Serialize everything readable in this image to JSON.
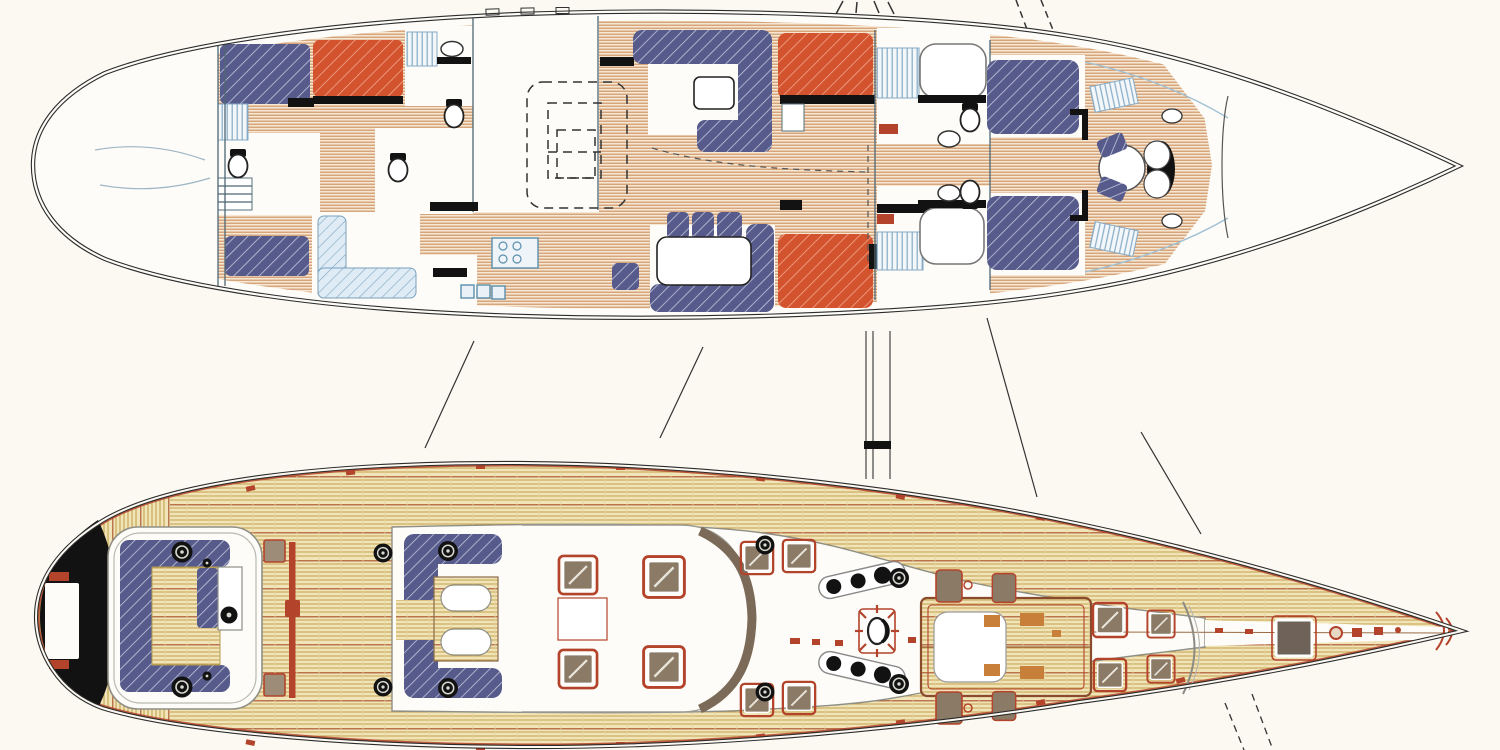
{
  "canvas": {
    "width": 1500,
    "height": 750,
    "background": "#fbf9f2"
  },
  "drawing": {
    "subject": "sailing-yacht-plans",
    "views": [
      {
        "id": "interior-accommodation-plan",
        "position": "top",
        "bow": "right",
        "features": [
          "owner-and-guest-berths",
          "salon-settees",
          "galley",
          "heads-with-wc-and-basins",
          "forward-seats",
          "companionway-dashed-outline"
        ],
        "berth_hatches": {
          "navy": 7,
          "red": 4,
          "light_blue": 2
        }
      },
      {
        "id": "teak-deck-plan",
        "position": "bottom",
        "bow": "right",
        "features": [
          "aft-cockpit",
          "center-cockpit",
          "coachroof-skylights",
          "genoa-tracks",
          "main-mast",
          "forward-skylight-box",
          "bow-hatch",
          "windlass",
          "dark-transom"
        ],
        "winches": 10,
        "skylight_hatches": 4,
        "deck_hatches": 8
      }
    ],
    "rigging_remnants": [
      "stay-lines-top-right",
      "leader-lines-between-views",
      "mast-lines-between-views",
      "stay-lines-bottom-right"
    ]
  },
  "colors": {
    "paper": "#fbf9f2",
    "paperin": "#fdfcf8",
    "line": "#2c2c2c",
    "wall": "#4f6673",
    "plank_base": "#f6e7d2",
    "plank_line": "#cd8f5e",
    "deck_base": "#f1e4b8",
    "deck_line": "#c2a14b",
    "deck_caulk": "#a84f2a",
    "navy": "#575b8b",
    "navy_hatch": "#c9cde2",
    "red": "#d4532f",
    "red_hatch": "#f2b197",
    "ltblue": "#dfecf5",
    "ltblue_hatch": "#85aac6",
    "fixture": "#5b8fae",
    "brown": "#8b7a66",
    "browndk": "#6f6359",
    "redtrim": "#b3432a",
    "black": "#121212",
    "shelf": "#9fc0d4"
  }
}
